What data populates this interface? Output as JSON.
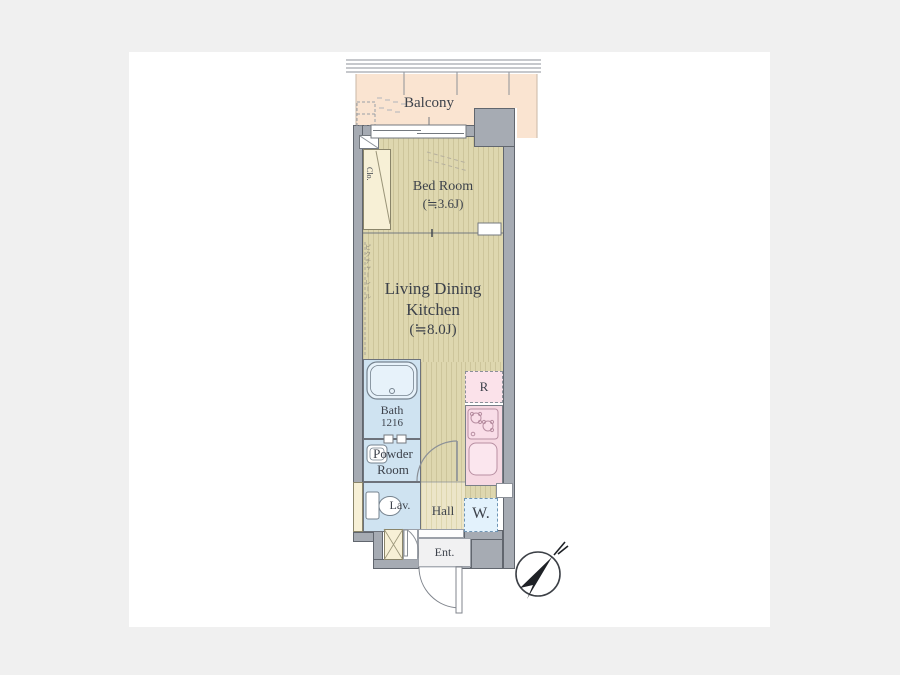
{
  "floorplan": {
    "balcony": "Balcony",
    "bedroom_label": "Bed Room",
    "bedroom_size": "(≒3.6J)",
    "ldk_line1": "Living Dining",
    "ldk_line2": "Kitchen",
    "ldk_size": "(≒8.0J)",
    "closet": "Clo.",
    "picture_rail": "ピクチャーレール",
    "bath_label": "Bath",
    "bath_size": "1216",
    "powder_line1": "Powder",
    "powder_line2": "Room",
    "lavatory": "Lav.",
    "hall": "Hall",
    "washer": "W.",
    "refrigerator": "R",
    "entrance": "Ent."
  },
  "colors": {
    "background": "#f0f0f0",
    "canvas": "#ffffff",
    "wall": "#a6abb3",
    "wall_outline": "#61666e",
    "flooring": "#ded7af",
    "flooring_stripe": "#cdc59b",
    "hall_floor": "#ece5c8",
    "balcony": "#fae4d1",
    "wet_area": "#cfe3f1",
    "kitchen_counter": "#f6d8e2",
    "refrigerator_area": "#fbe2ea",
    "washer_area": "#e3f2fc",
    "closet_fill": "#f7f0d6",
    "entrance_floor": "#f1f1f2",
    "text": "#3d424b"
  }
}
